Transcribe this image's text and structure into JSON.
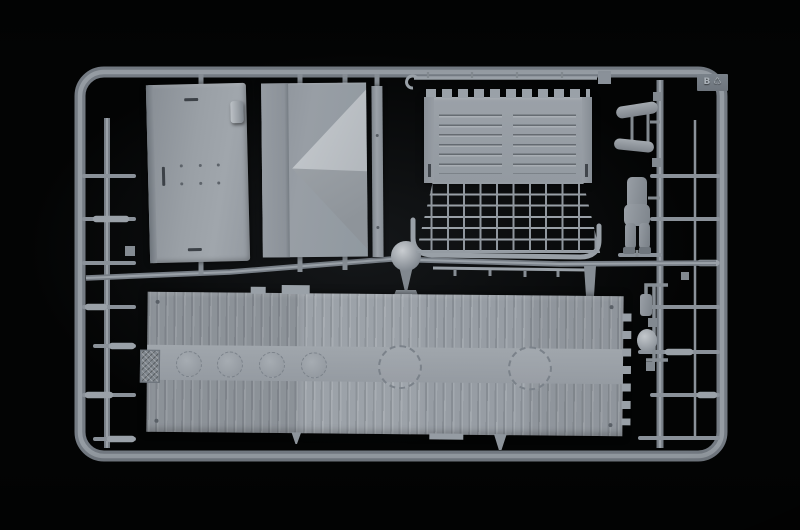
{
  "photo": {
    "description": "overhead photo of a light grey injection-moulded model kit sprue on a black background",
    "background_color": "#030404",
    "plastic_color": "#9aa1a8",
    "plastic_shadow_color": "#6e757d",
    "plastic_highlight_color": "#c9cdd1"
  },
  "sprue": {
    "tag": {
      "label": "B",
      "recycle_symbol": "♺"
    },
    "parts": [
      "flat door panel with rivet holes",
      "folded tarpaulin cover",
      "thin plank strip",
      "ribbed tailgate with castellated edge",
      "mesh ramp grating with curved hand rail",
      "long plank deck with round hatches and toothed edge",
      "tow rod with hook",
      "figure arms pair",
      "figure torso and legs",
      "ball fitting",
      "small valve and hook fittings"
    ]
  }
}
